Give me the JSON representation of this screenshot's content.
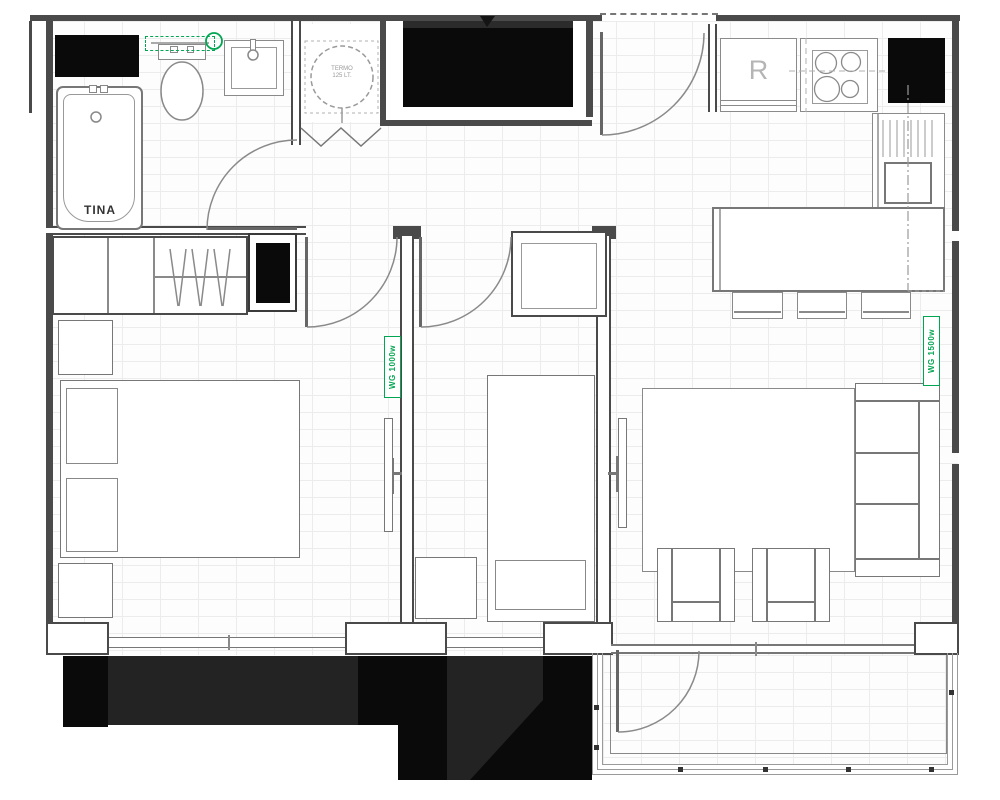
{
  "plan": {
    "labels": {
      "bathtub": "TINA",
      "water_heater_line1": "TERMO",
      "water_heater_line2": "125 LT.",
      "refrigerator": "R",
      "heater_left": "WG 1000w",
      "heater_right": "WG 1500w"
    },
    "colors": {
      "wall": "#4a4a4a",
      "furniture_stroke": "#8a8a8a",
      "accent_green": "#00a651",
      "black_fill": "#0a0a0a",
      "dark_gray_fill": "#232323"
    }
  }
}
